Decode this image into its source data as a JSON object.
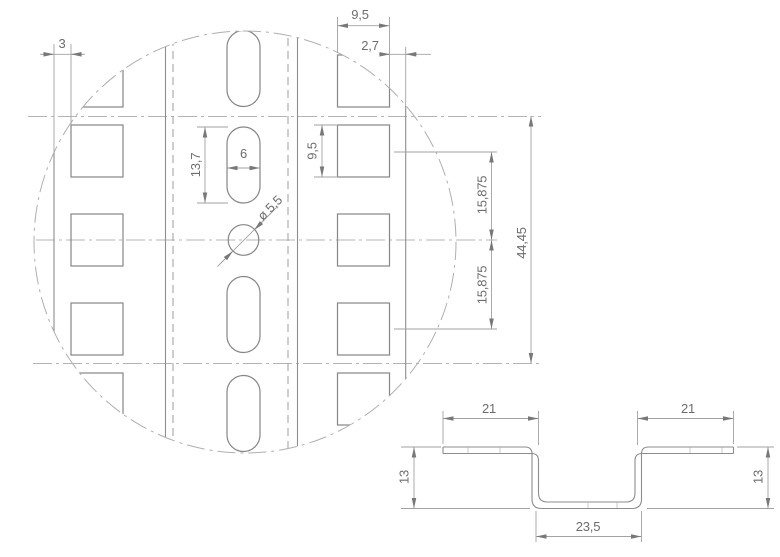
{
  "drawing": {
    "background": "#ffffff",
    "geometry_line_color": "#8d8d8d",
    "dimension_line_color": "#a2a2a2",
    "text_color": "#6d6d6d",
    "detail_view": {
      "description": "flat rail detail circle with square holes, slotted holes and round hole",
      "dims": {
        "edge_offset_left": "3",
        "square_width": "9,5",
        "edge_offset_right": "2,7",
        "square_height": "9,5",
        "slot_length": "13,7",
        "slot_width": "6",
        "hole_diameter": "ø 5,5",
        "row_pitch_upper": "15,875",
        "row_pitch_lower": "15,875",
        "unit_height": "44,45"
      }
    },
    "section_view": {
      "description": "hat profile cross section",
      "dims": {
        "flange_left": "21",
        "flange_right": "21",
        "depth_left": "13",
        "depth_right": "13",
        "channel_width": "23,5"
      }
    }
  }
}
